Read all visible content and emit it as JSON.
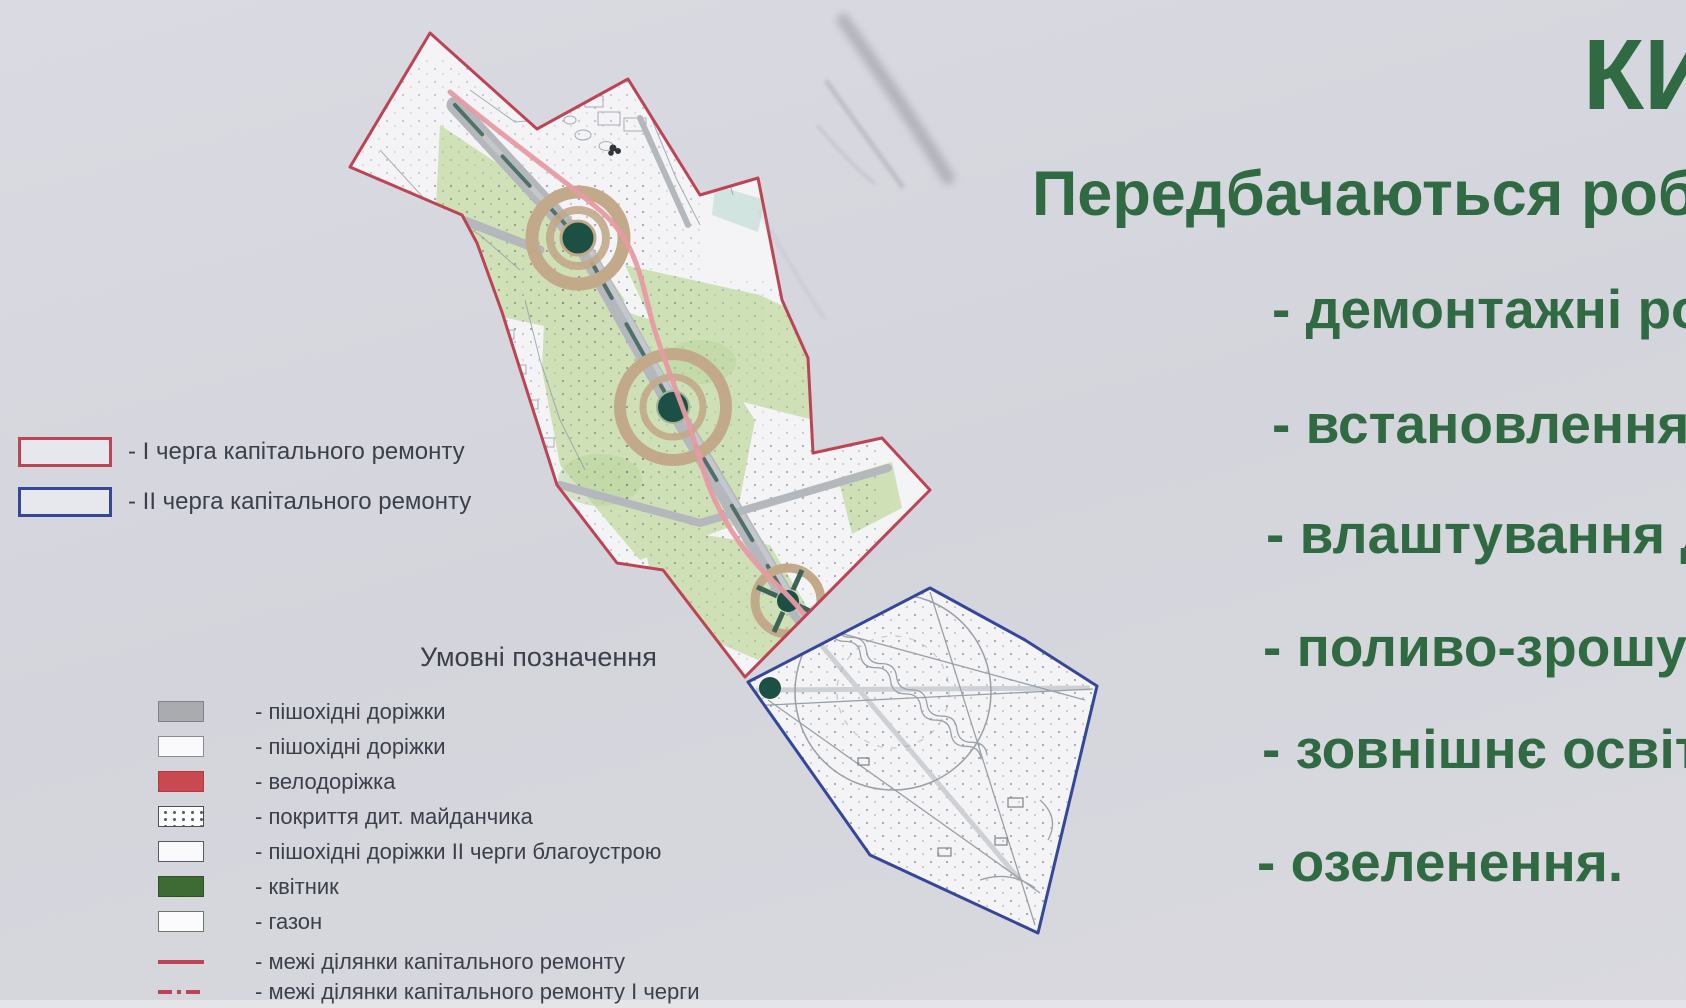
{
  "colors": {
    "board_bg": "#d7d8de",
    "green_text": "#2f6a42",
    "dark_text": "#3b404b",
    "phase1_red": "#bc4455",
    "phase2_blue": "#35479a",
    "lawn_green": "#cddfb3",
    "path_gray": "#b4b7bb",
    "ring_tan": "#c2a98a",
    "flowerbed_green": "#1c5044",
    "bike_pink": "#e79aa3"
  },
  "right_panel": {
    "title_fragment": "КИ",
    "heading": "Передбачаються роботи",
    "works": [
      "- демонтажні роб",
      "- встановлення ла",
      "- влаштування до",
      "- поливо-зрошува",
      "- зовнішнє освітле",
      "- озеленення."
    ]
  },
  "phase_legend": {
    "items": [
      {
        "label": "- І черга капітального ремонту"
      },
      {
        "label": "- ІІ черга капітального ремонту"
      }
    ]
  },
  "map_legend": {
    "title": "Умовні позначення",
    "items": [
      {
        "label": "- пішохідні доріжки"
      },
      {
        "label": "- пішохідні доріжки"
      },
      {
        "label": "- велодоріжка"
      },
      {
        "label": "- покриття дит. майданчика"
      },
      {
        "label": "- пішохідні доріжки ІІ черги благоустрою"
      },
      {
        "label": "- квітник"
      },
      {
        "label": "- газон"
      },
      {
        "label": "- межі ділянки капітального ремонту"
      },
      {
        "label": "- межі ділянки капітального ремонту І черги"
      }
    ]
  }
}
